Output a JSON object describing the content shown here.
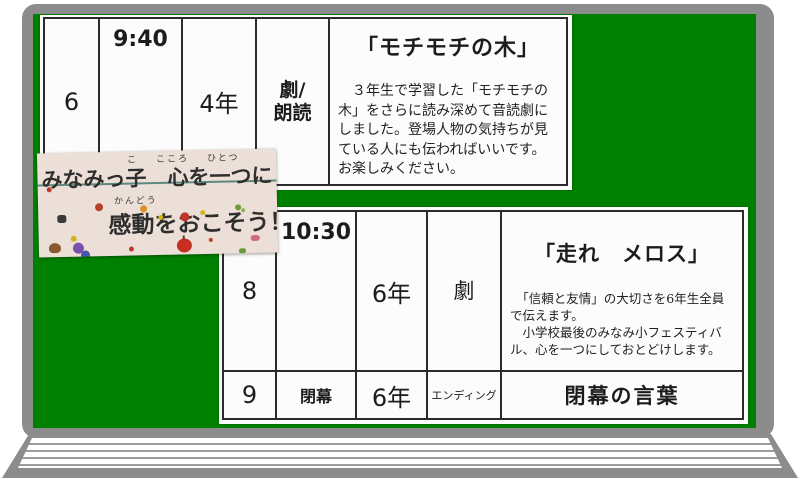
{
  "board": {
    "surface_color": "#008000",
    "frame_color": "#8c8c8c",
    "paper_color": "#fcfcfc"
  },
  "banner": {
    "ruby_ko": "こ",
    "ruby_kokoro": "こころ",
    "ruby_hitotsu": "ひとつ",
    "line1": "みなみっ子　心を一つに",
    "ruby_kandou": "かんどう",
    "line2": "感動をおこそう！！"
  },
  "schedule": {
    "top": {
      "number": "6",
      "time": "9:40",
      "grade": "4年",
      "category": "劇/\n朗読",
      "title": "「モチモチの木」",
      "description": "　３年生で学習した「モチモチの\n木」をさらに読み深めて音読劇に\nしました。登場人物の気持ちが見\nている人にも伝わればいいです。\nお楽しみください。"
    },
    "bottom_row8": {
      "number": "8",
      "time": "10:30",
      "grade": "6年",
      "category": "劇",
      "title": "「走れ　メロス」",
      "description": "　「信頼と友情」の大切さを6年生全員\nで伝えます。\n　小学校最後のみなみ小フェスティバ\nル、心を一つにしておとどけします。"
    },
    "bottom_row9": {
      "number": "9",
      "time": "閉幕",
      "grade": "6年",
      "category": "エンディング",
      "title": "閉幕の言葉"
    }
  }
}
